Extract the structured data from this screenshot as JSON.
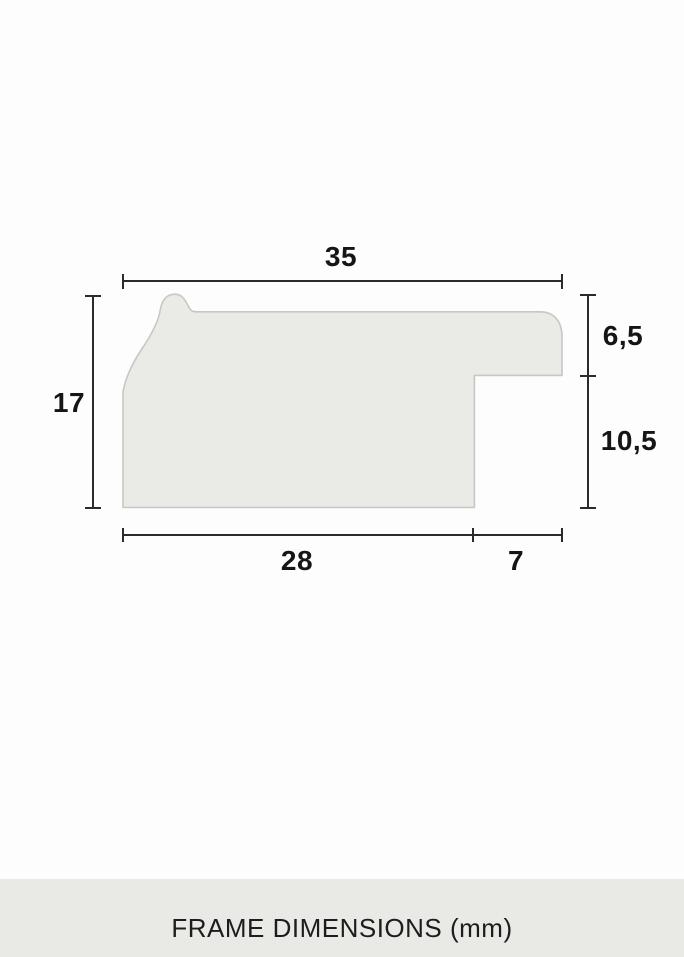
{
  "diagram": {
    "dimensions": {
      "top_width_label": "35",
      "left_height_label": "17",
      "right_top_label": "6,5",
      "right_bottom_label": "10,5",
      "bottom_left_label": "28",
      "bottom_right_label": "7"
    },
    "colors": {
      "profile_fill": "#eaebe7",
      "profile_stroke": "#c6c8c2",
      "dimension_line": "#2b2b2b",
      "label_text": "#151515"
    }
  },
  "footer": {
    "label": "FRAME DIMENSIONS (mm)",
    "background": "#e9eae6"
  }
}
